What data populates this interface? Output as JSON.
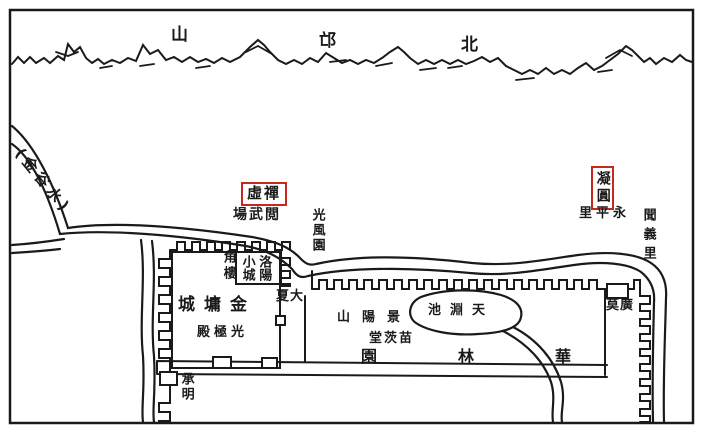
{
  "meta": {
    "type": "scanned hand-drawn historical map (black ink on white, red highlight boxes)",
    "subject": "Northern Wei Luoyang, area north of the city: Jinyong City and Hualin Garden",
    "reading_note": "horizontal Chinese labels read right-to-left; 'display' strings give glyphs in on-screen left-to-right order"
  },
  "palette": {
    "ink": "#1a1a1a",
    "paper": "#ffffff",
    "highlight_red": "#c5281c"
  },
  "mountains": {
    "chars": [
      "山",
      "邙",
      "北"
    ],
    "reading": "北邙山"
  },
  "labels": {
    "jingu_shui": {
      "display": "(金谷水)",
      "reading": "金谷水"
    },
    "chanxu": {
      "display": "虛禪",
      "reading": "禪虛",
      "boxed": true
    },
    "yuewuchang": {
      "display": "場武閲",
      "reading": "閲武場"
    },
    "guangfengyuan": {
      "display": "光風園",
      "reading": "光風園"
    },
    "luoyang_xiaocheng": {
      "col_left": "小城",
      "col_right": "洛陽",
      "reading": "洛陽小城"
    },
    "jiaolou": {
      "display": "角樓",
      "reading": "角樓"
    },
    "jinyongcheng": {
      "display": "城墉金",
      "reading": "金墉城"
    },
    "guangjidian": {
      "display": "殿極光",
      "reading": "光極殿"
    },
    "daxia": {
      "display": "夏大",
      "reading": "大夏(門)"
    },
    "chengming": {
      "display": "承明",
      "reading": "承明(門)"
    },
    "tianyuanchi": {
      "display": "池淵天",
      "reading": "天淵池"
    },
    "jingyangshan": {
      "display": "山陽景",
      "reading": "景陽山"
    },
    "miaocitang": {
      "display": "堂茨苗",
      "reading": "苗茨堂"
    },
    "hualinyuan": {
      "chars": [
        "園",
        "林",
        "華"
      ],
      "reading": "華林園"
    },
    "guangmo": {
      "display": "莫廣",
      "reading": "廣莫(門)"
    },
    "ningyuan": {
      "display": "凝圓",
      "reading": "凝圓",
      "boxed": true
    },
    "yongpingli": {
      "display": "里平永",
      "reading": "永平里"
    },
    "wenyili": {
      "display": "聞義里",
      "reading": "聞義里"
    }
  }
}
